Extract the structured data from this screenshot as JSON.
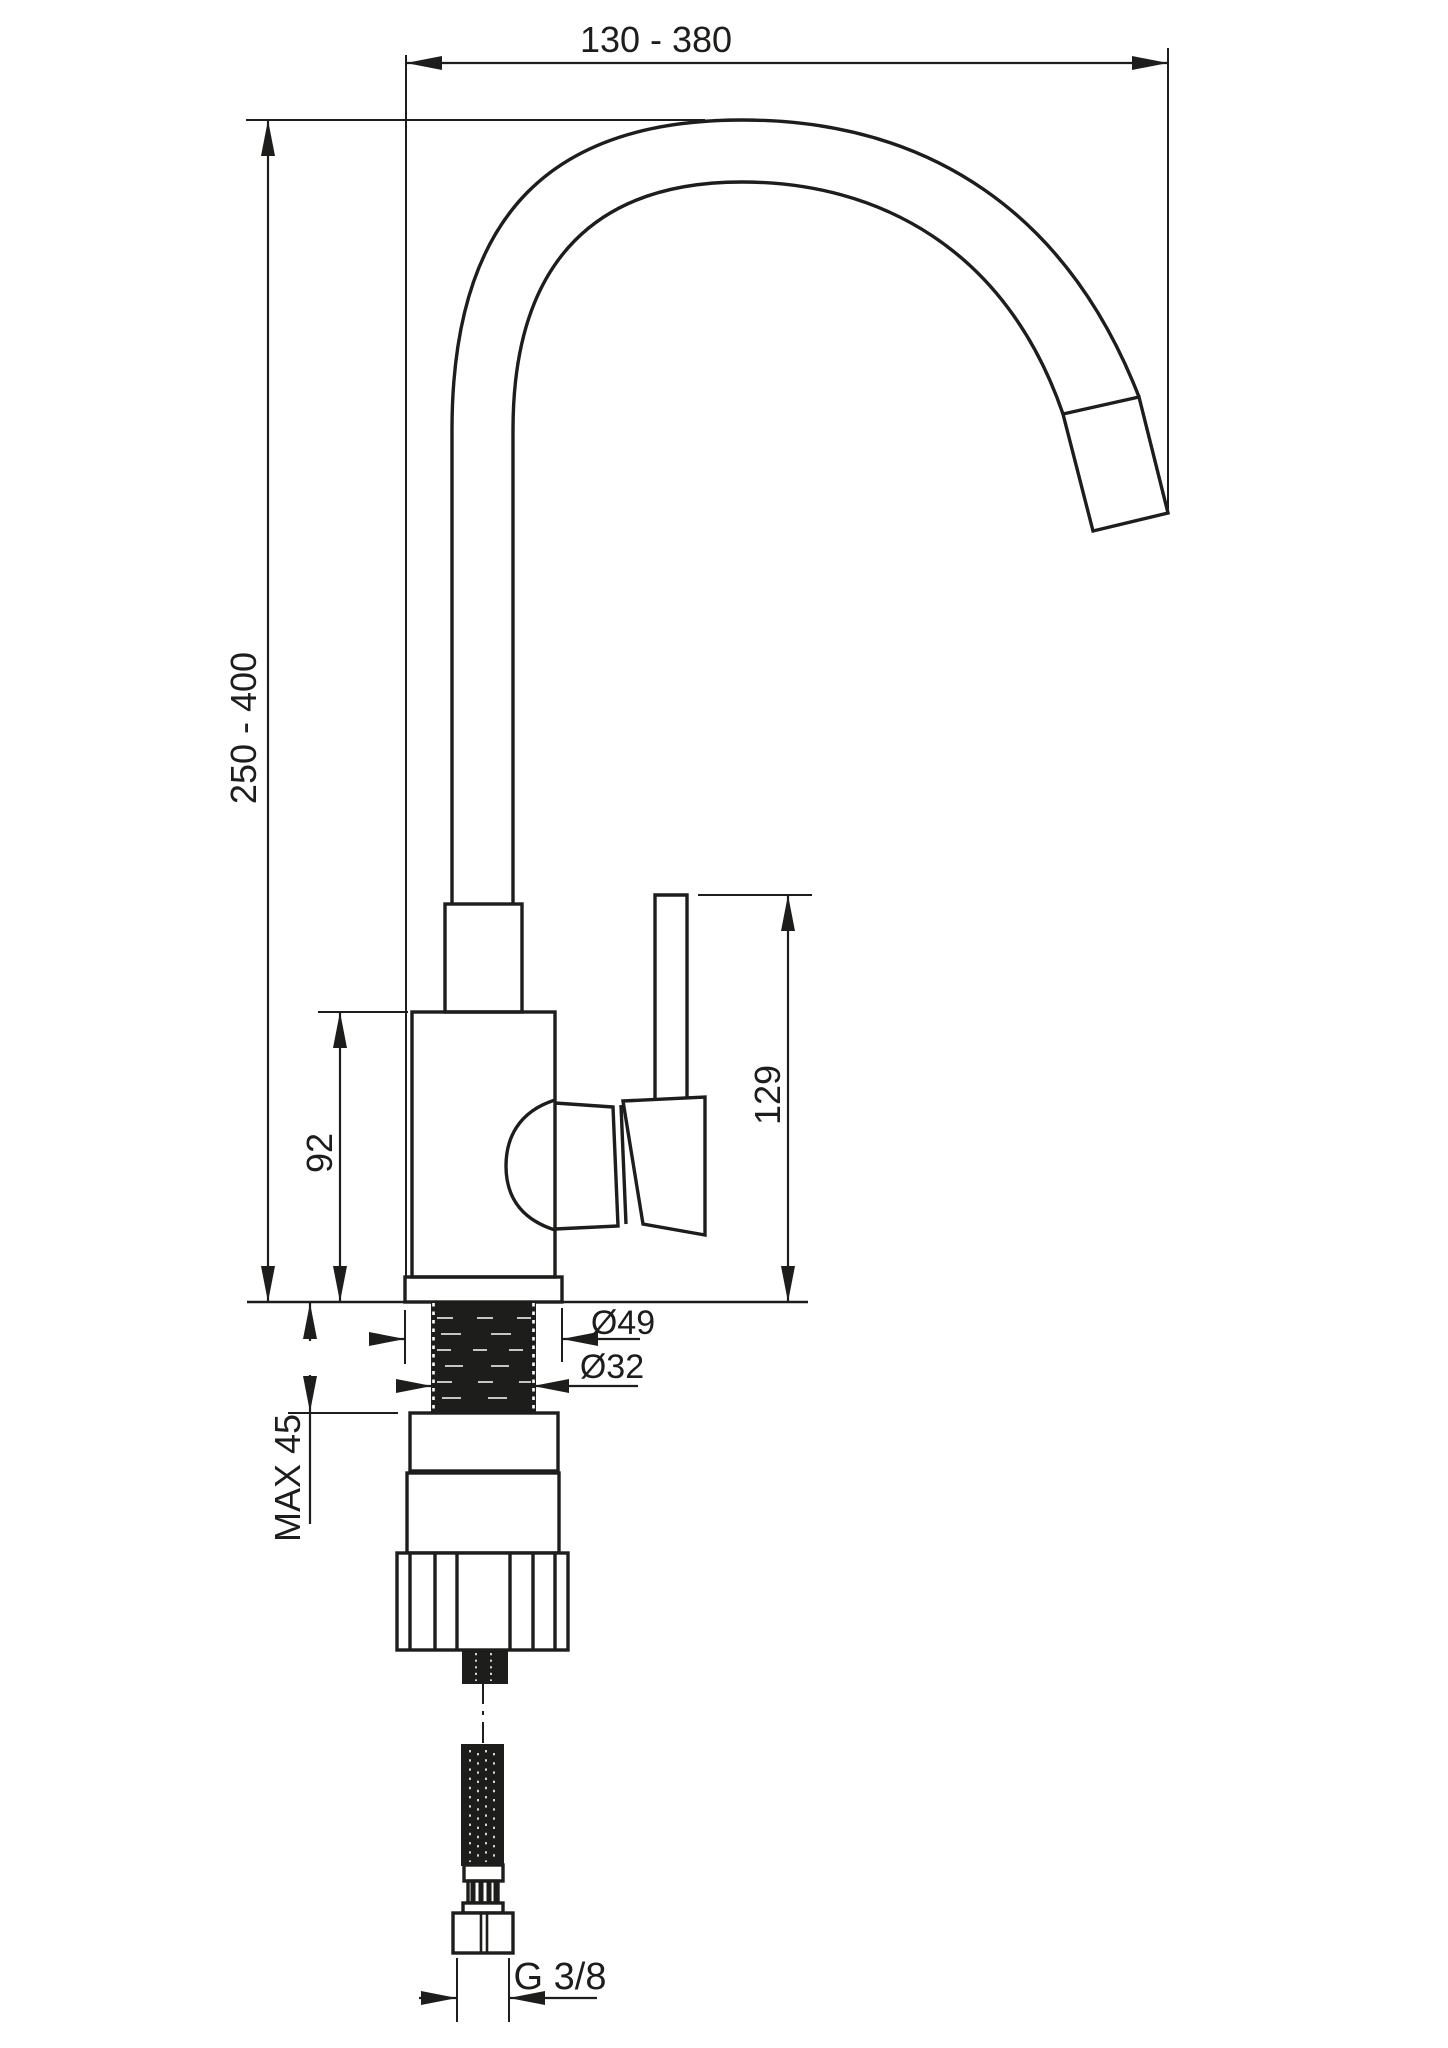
{
  "colors": {
    "background": "#ffffff",
    "line": "#1d1d1b"
  },
  "labels": {
    "spout_reach": "130 - 380",
    "total_height": "250 - 400",
    "body_height": "92",
    "handle_top_height": "129",
    "base_diameter": "Ø49",
    "shank_diameter": "Ø32",
    "max_mounting_thickness": "MAX 45",
    "hose_connection": "G 3/8"
  }
}
